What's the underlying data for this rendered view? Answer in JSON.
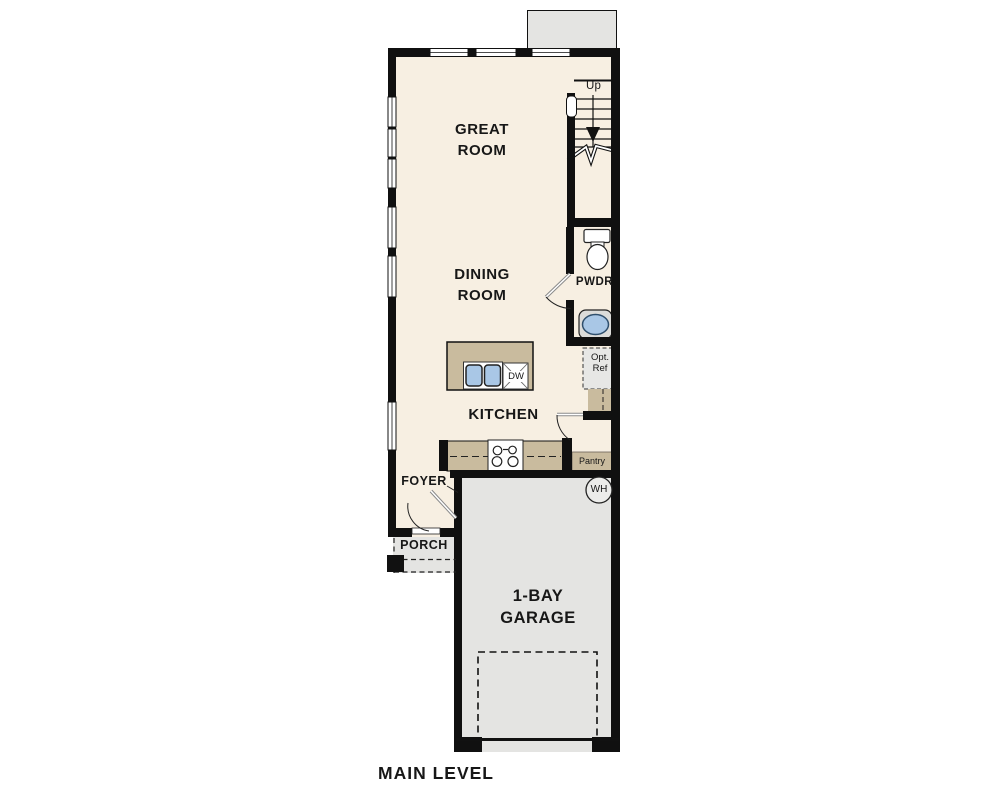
{
  "title": "MAIN LEVEL",
  "rooms": {
    "great_room": "GREAT ROOM",
    "dining_room": "DINING ROOM",
    "kitchen": "KITCHEN",
    "foyer": "FOYER",
    "porch": "PORCH",
    "garage": "1-BAY GARAGE",
    "powder_room": "PWDR",
    "pantry": "Pantry",
    "optional_refrigerator": "Opt. Ref"
  },
  "labels": {
    "stairs_up": "Up",
    "dishwasher": "DW",
    "water_heater": "WH"
  },
  "colors": {
    "floor": "#f7efe2",
    "concrete": "#e4e4e2",
    "counter": "#c9bb9e",
    "wall": "#101010",
    "sink": "#a9c7e6"
  }
}
